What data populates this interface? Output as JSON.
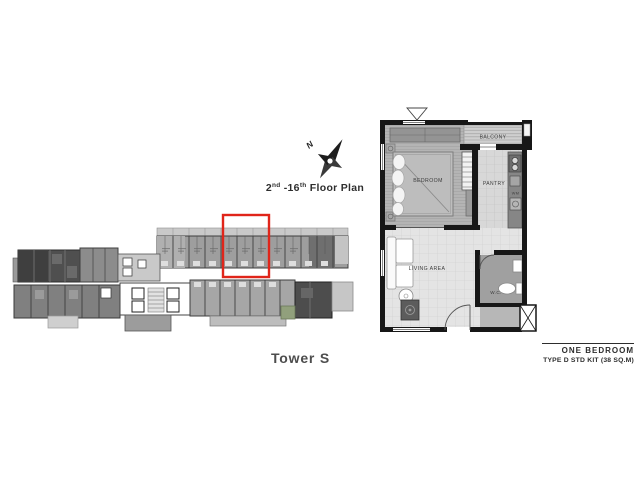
{
  "compass": {
    "north_label": "N"
  },
  "plan_header": {
    "range_start": "2",
    "range_start_sup": "nd",
    "range_mid": " -16",
    "range_end_sup": "th",
    "label": " Floor Plan"
  },
  "tower": {
    "name": "Tower S",
    "highlight_color": "#e0251a"
  },
  "unit_plan": {
    "rooms": {
      "bedroom": "BEDROOM",
      "balcony": "BALCONY",
      "pantry": "PANTRY",
      "living_area": "LIVING AREA",
      "wc": "W.C.",
      "washing_machine": "WM"
    }
  },
  "unit_caption": {
    "title": "ONE BEDROOM",
    "subtitle": "TYPE D STD KIT (38 SQ.M)"
  }
}
